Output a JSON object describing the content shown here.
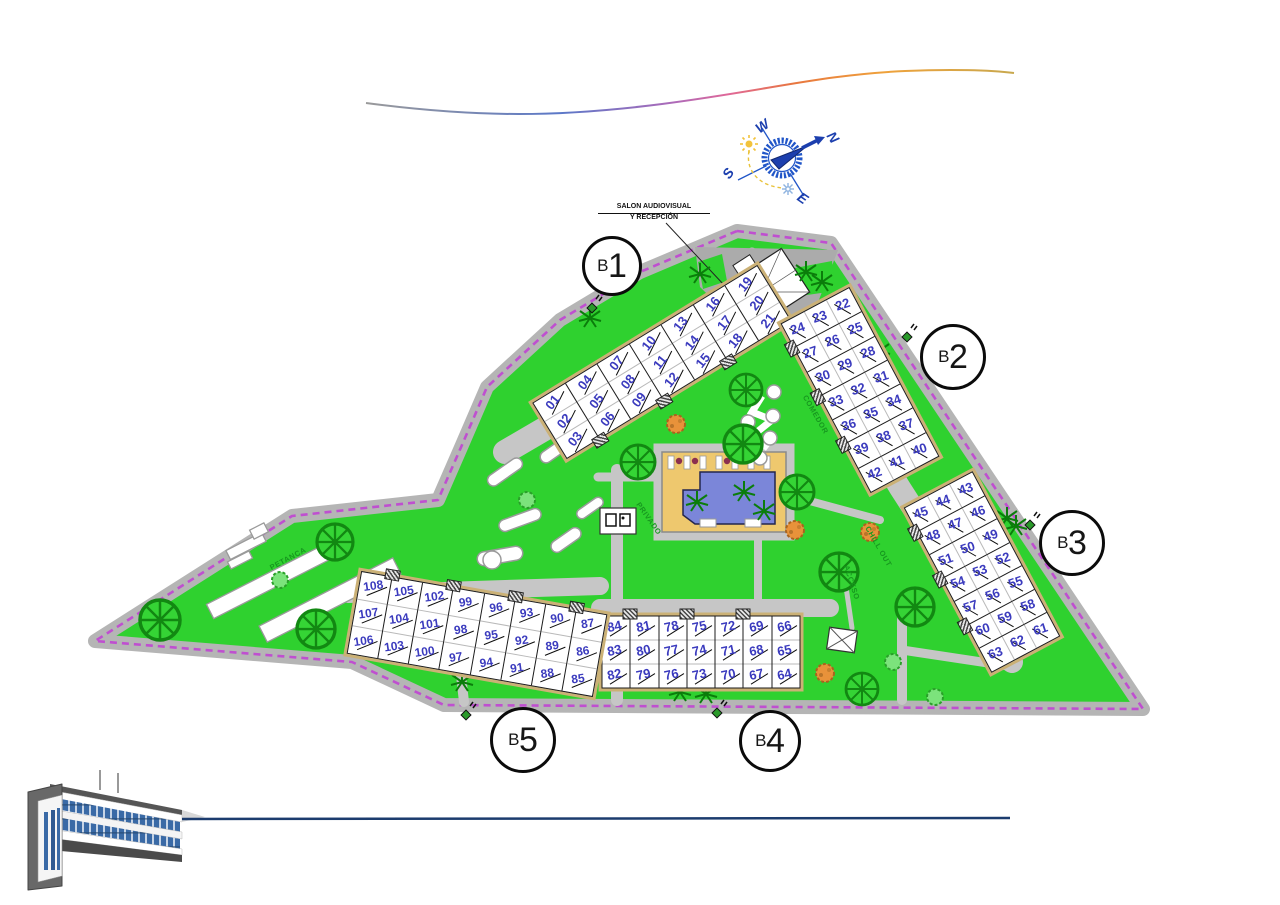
{
  "annotations": {
    "reception_line1": "SALON AUDIOVISUAL",
    "reception_line2": "Y RECEPCIÓN"
  },
  "compass": {
    "north": "N",
    "south": "S",
    "east": "E",
    "west": "W"
  },
  "area_labels": {
    "petanca": "PETANCA",
    "privado": "PRIVADO",
    "comedor": "COMEDOR",
    "chill_out": "CHILL OUT",
    "acceso": "ACCESO"
  },
  "blocks": [
    {
      "id": "B1",
      "prefix": "B",
      "number": "1",
      "groups": [
        [
          "01",
          "02",
          "03"
        ],
        [
          "04",
          "05",
          "06"
        ],
        [
          "07",
          "08",
          "09"
        ],
        [
          "10",
          "11",
          "12"
        ],
        [
          "13",
          "14",
          "15"
        ],
        [
          "16",
          "17",
          "18"
        ],
        [
          "19",
          "20",
          "21"
        ]
      ]
    },
    {
      "id": "B2",
      "prefix": "B",
      "number": "2",
      "groups": [
        [
          "22",
          "23",
          "24"
        ],
        [
          "25",
          "26",
          "27"
        ],
        [
          "28",
          "29",
          "30"
        ],
        [
          "31",
          "32",
          "33"
        ],
        [
          "34",
          "35",
          "36"
        ],
        [
          "37",
          "38",
          "39"
        ],
        [
          "40",
          "41",
          "42"
        ]
      ]
    },
    {
      "id": "B3",
      "prefix": "B",
      "number": "3",
      "groups": [
        [
          "43",
          "44",
          "45"
        ],
        [
          "46",
          "47",
          "48"
        ],
        [
          "49",
          "50",
          "51"
        ],
        [
          "52",
          "53",
          "54"
        ],
        [
          "55",
          "56",
          "57"
        ],
        [
          "58",
          "59",
          "60"
        ],
        [
          "61",
          "62",
          "63"
        ]
      ]
    },
    {
      "id": "B4",
      "prefix": "B",
      "number": "4",
      "groups": [
        [
          "84",
          "83",
          "82"
        ],
        [
          "81",
          "80",
          "79"
        ],
        [
          "78",
          "77",
          "76"
        ],
        [
          "75",
          "74",
          "73"
        ],
        [
          "72",
          "71",
          "70"
        ],
        [
          "69",
          "68",
          "67"
        ],
        [
          "66",
          "65",
          "64"
        ]
      ]
    },
    {
      "id": "B5",
      "prefix": "B",
      "number": "5",
      "groups": [
        [
          "108",
          "107",
          "106"
        ],
        [
          "105",
          "104",
          "103"
        ],
        [
          "102",
          "101",
          "100"
        ],
        [
          "99",
          "98",
          "97"
        ],
        [
          "96",
          "95",
          "94"
        ],
        [
          "93",
          "92",
          "91"
        ],
        [
          "90",
          "89",
          "88"
        ],
        [
          "87",
          "86",
          "85"
        ]
      ]
    }
  ],
  "colors": {
    "boundary_dash": "#bf4fd0",
    "lawn": "#2fd12f",
    "road": "#c2c2c2",
    "unit_number": "#3b3bbe",
    "pool_water": "#7b86d9",
    "pool_deck": "#eec86e",
    "navy_line": "#1c3c6e",
    "compass_blue": "#2156c8"
  }
}
